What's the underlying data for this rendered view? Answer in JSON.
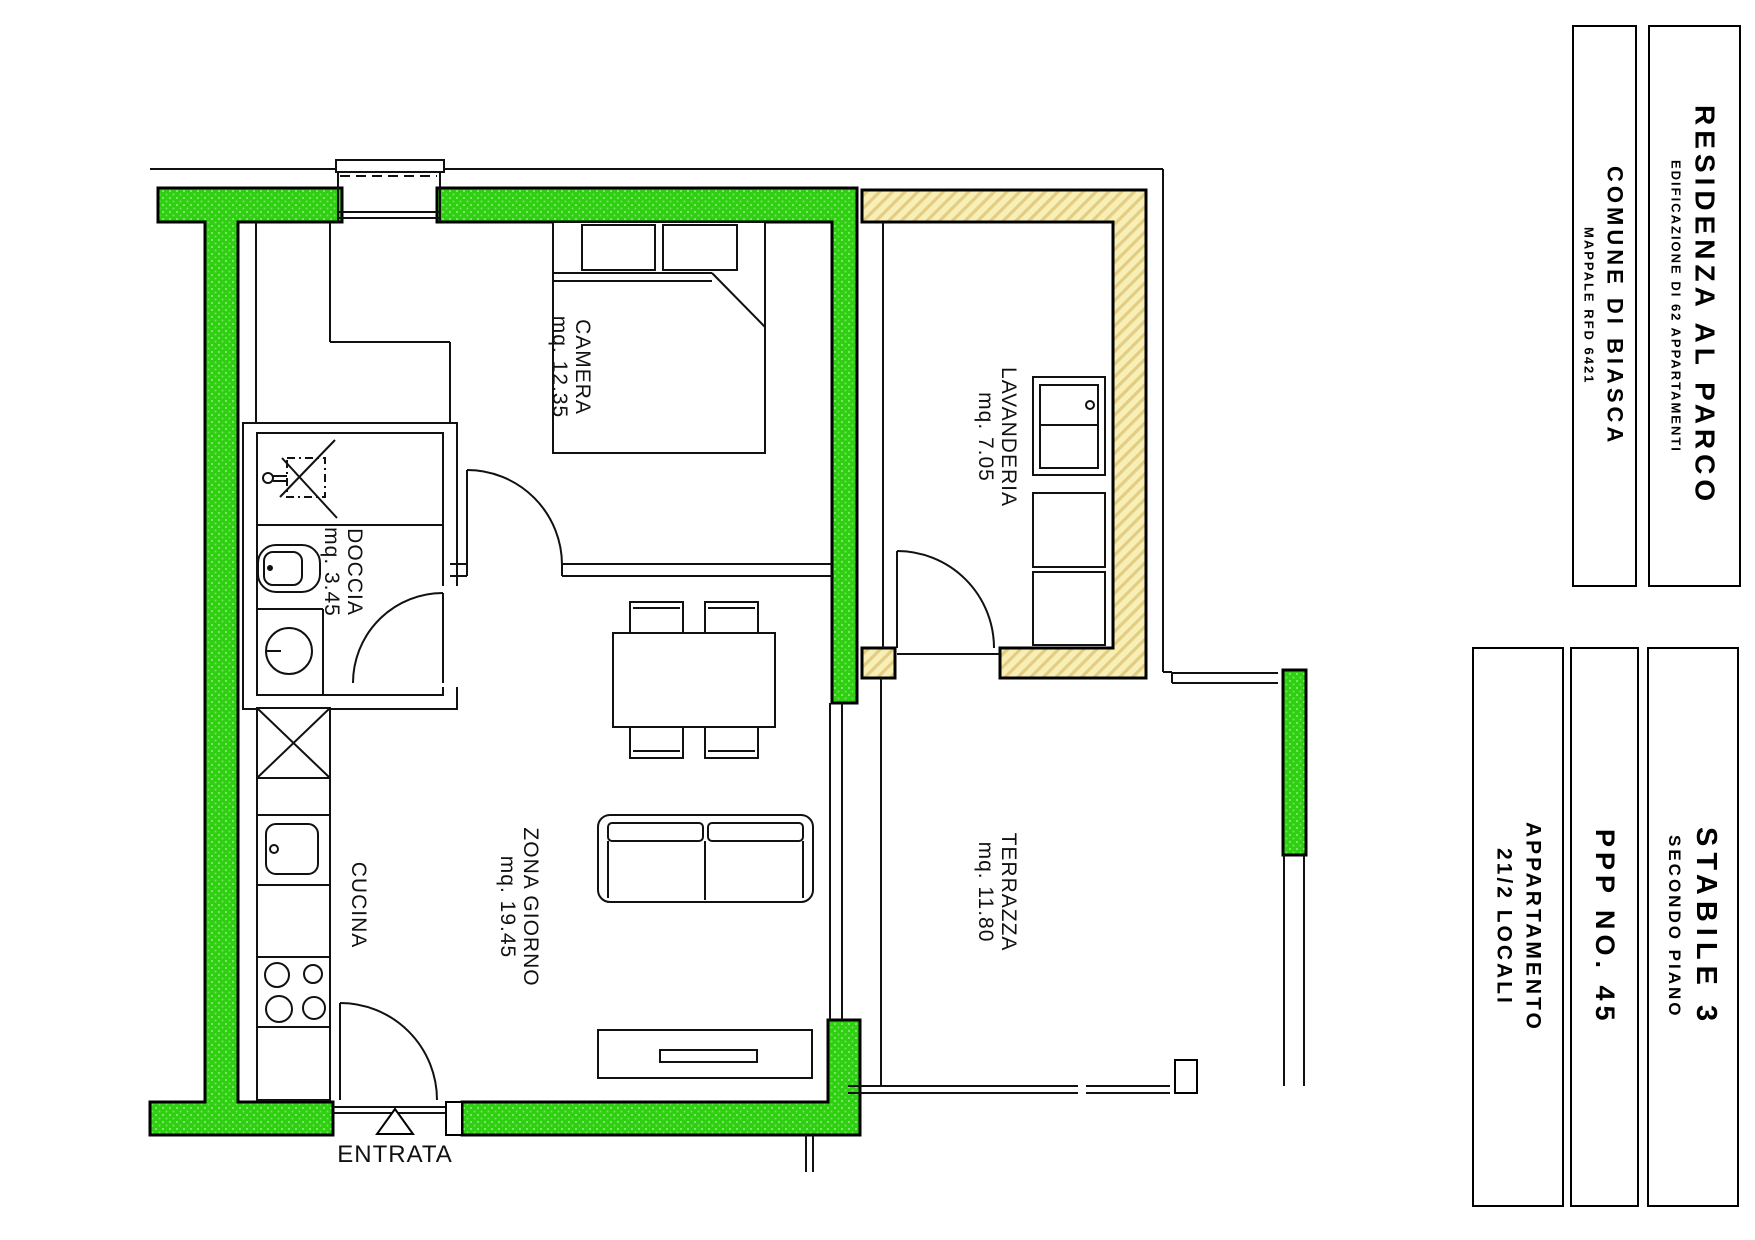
{
  "drawing": {
    "kind": "apartment floor plan",
    "colors": {
      "apartment_wall_green": "#2FD011",
      "external_wall_yellow": "#F8EFB7",
      "hatch_yellow": "#E3CD82",
      "line_black": "#000000"
    }
  },
  "rooms": {
    "camera": {
      "name": "CAMERA",
      "area": "mq. 12.35"
    },
    "doccia": {
      "name": "DOCCIA",
      "area": "mq. 3.45"
    },
    "zona_giorno": {
      "name": "ZONA GIORNO",
      "area": "mq. 19.45"
    },
    "cucina": {
      "name": "CUCINA"
    },
    "lavanderia": {
      "name": "LAVANDERIA",
      "area": "mq. 7.05"
    },
    "terrazza": {
      "name": "TERRAZZA",
      "area": "mq. 11.80"
    },
    "entrata": {
      "name": "ENTRATA"
    }
  },
  "title_blocks": {
    "residenza": {
      "title": "RESIDENZA AL PARCO",
      "subtitle": "EDIFICAZIONE DI 62 APPARTAMENTI"
    },
    "comune": {
      "title": "COMUNE DI BIASCA",
      "subtitle": "MAPPALE RFD 6421"
    },
    "stabile": {
      "title": "STABILE 3",
      "subtitle": "SECONDO PIANO"
    },
    "ppp": {
      "title": "PPP NO. 45"
    },
    "appartamento": {
      "title": "APPARTAMENTO",
      "subtitle": "21/2 LOCALI"
    }
  }
}
